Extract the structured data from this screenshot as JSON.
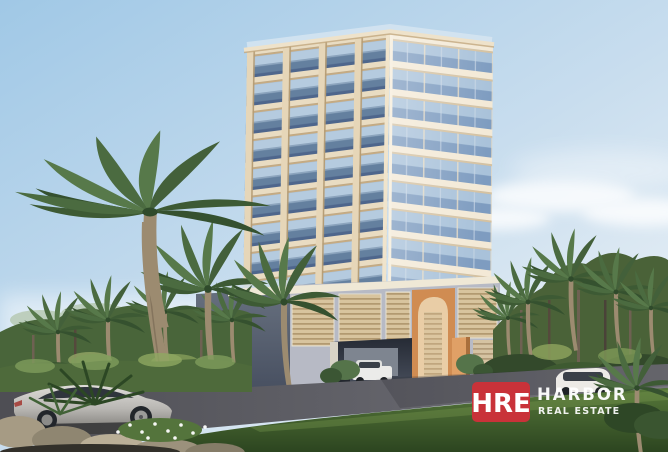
{
  "watermark": {
    "badge_text": "HRE",
    "brand_name": "HARBOR",
    "brand_subtitle": "REAL ESTATE",
    "badge_color": "#c93239",
    "text_color": "#ffffff"
  },
  "palette": {
    "sky_top": "#a3cae6",
    "sky_light": "#eef3f7",
    "building_slab": "#ecdcc2",
    "building_glass": "#7f9dc0",
    "podium_accent": "#d08c52",
    "foliage_dark": "#3d5a34",
    "foliage_light": "#57794a",
    "road": "#5a5a60",
    "lawn": "#49672f"
  }
}
